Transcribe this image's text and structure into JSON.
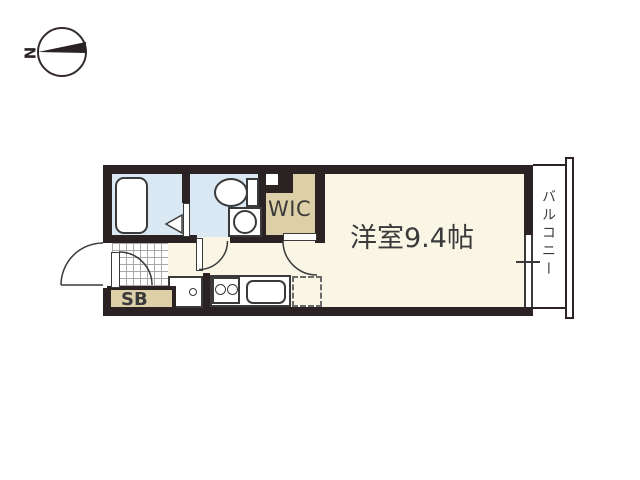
{
  "floorplan": {
    "compass": {
      "north_label": "N"
    },
    "rooms": {
      "main_room": {
        "label": "洋室9.4帖"
      },
      "wic": {
        "label": "WIC"
      },
      "shoe_box": {
        "label": "SB"
      },
      "balcony": {
        "label": "バルコニー"
      }
    },
    "colors": {
      "wall": "#2b2224",
      "wet_area": "#d9e8f3",
      "closet": "#ddd0a8",
      "floor": "#faf6e6",
      "outline": "#3a3a3a"
    }
  }
}
